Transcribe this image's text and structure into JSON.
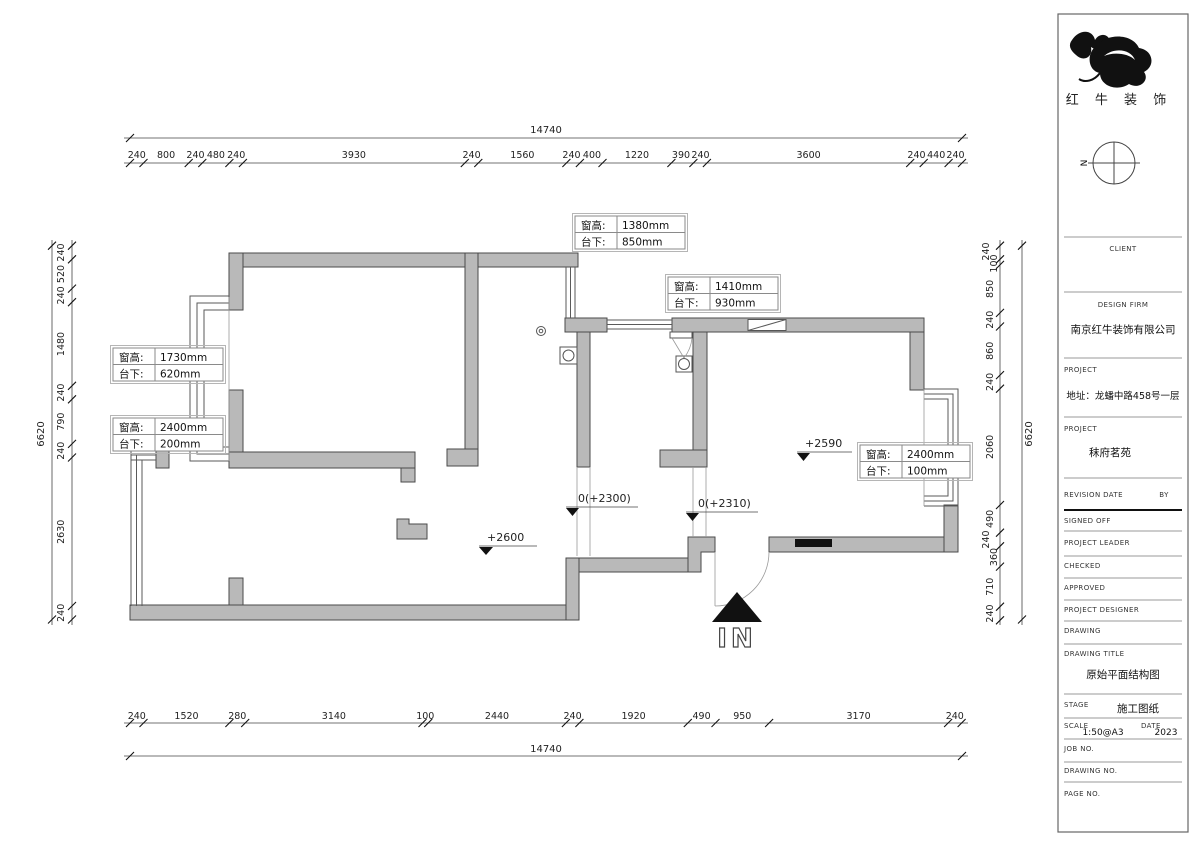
{
  "colors": {
    "wall_fill": "#b9b9b9",
    "wall_stroke": "#4a4a4a",
    "accent_black": "#111111"
  },
  "dimensions": {
    "top_total": "14740",
    "bottom_total": "14740",
    "left_total": "6620",
    "right_total": "6620",
    "top": [
      "240",
      "800",
      "240",
      "480",
      "240",
      "3930",
      "240",
      "1560",
      "240",
      "400",
      "1220",
      "390",
      "240",
      "3600",
      "240",
      "440",
      "240"
    ],
    "bottom": [
      "240",
      "1520",
      "280",
      "3140",
      "100",
      "2440",
      "240",
      "1920",
      "490",
      "950",
      "3170",
      "240"
    ],
    "left": [
      "240",
      "520",
      "240",
      "1480",
      "240",
      "790",
      "240",
      "2630",
      "240"
    ],
    "right": [
      "240",
      "100",
      "850",
      "240",
      "860",
      "240",
      "2060",
      "490",
      "240",
      "360",
      "710",
      "240"
    ]
  },
  "annotations": {
    "window_labels": [
      {
        "k1": "窗高:",
        "v1": "1380mm",
        "k2": "台下:",
        "v2": "850mm"
      },
      {
        "k1": "窗高:",
        "v1": "1410mm",
        "k2": "台下:",
        "v2": "930mm"
      },
      {
        "k1": "窗高:",
        "v1": "1730mm",
        "k2": "台下:",
        "v2": "620mm"
      },
      {
        "k1": "窗高:",
        "v1": "2400mm",
        "k2": "台下:",
        "v2": "200mm"
      },
      {
        "k1": "窗高:",
        "v1": "2400mm",
        "k2": "台下:",
        "v2": "100mm"
      }
    ],
    "elevations": {
      "living_room": "+2600",
      "kitchen_threshold": "0(+2300)",
      "hall_threshold": "0(+2310)",
      "dining_room": "+2590"
    },
    "entrance_label": "IN",
    "compass_label": "N"
  },
  "title_block": {
    "company_logo_text": "红 牛 装 饰",
    "client_label": "CLIENT",
    "design_firm_label": "DESIGN FIRM",
    "design_firm_value": "南京红牛装饰有限公司",
    "project_label": "PROJECT",
    "project_address": "地址：龙蟠中路458号一层",
    "project_name": "秣府茗苑",
    "revision_label": "REVISION",
    "date_label": "DATE",
    "by_label": "BY",
    "signed_off_label": "SIGNED OFF",
    "project_leader_label": "PROJECT LEADER",
    "checked_label": "CHECKED",
    "approved_label": "APPROVED",
    "project_designer_label": "PROJECT DESIGNER",
    "drawing_label": "DRAWING",
    "drawing_title_label": "DRAWING TITLE",
    "drawing_title_value": "原始平面结构图",
    "stage_label": "STAGE",
    "stage_value": "施工图纸",
    "scale_label": "SCALE",
    "scale_value": "1:50@A3",
    "date_field_label": "DATE",
    "date_value": "2023",
    "job_no_label": "JOB NO.",
    "drawing_no_label": "DRAWING NO.",
    "page_no_label": "PAGE NO."
  }
}
